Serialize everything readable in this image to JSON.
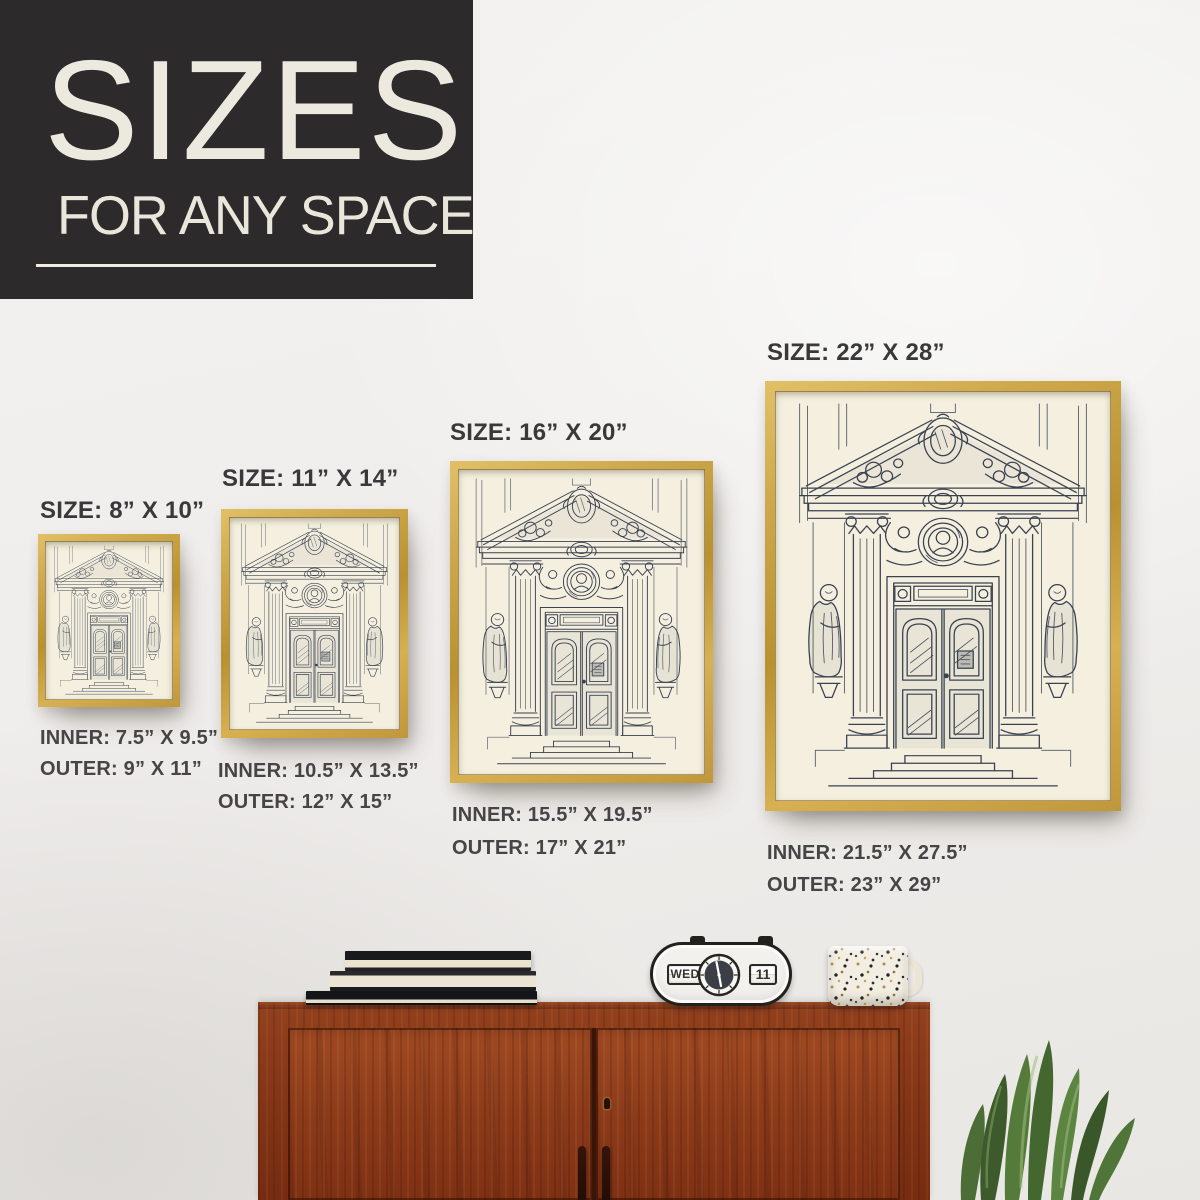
{
  "header": {
    "title": "SIZES",
    "subtitle": "FOR ANY SPACE"
  },
  "frames": [
    {
      "id": "8x10",
      "size_label": "SIZE: 8” X 10”",
      "inner_label": "INNER: 7.5” X 9.5”",
      "outer_label": "OUTER: 9” X 11”"
    },
    {
      "id": "11x14",
      "size_label": "SIZE: 11” X 14”",
      "inner_label": "INNER: 10.5” X 13.5”",
      "outer_label": "OUTER: 12” X 15”"
    },
    {
      "id": "16x20",
      "size_label": "SIZE: 16” X 20”",
      "inner_label": "INNER: 15.5” X 19.5”",
      "outer_label": "OUTER: 17” X 21”"
    },
    {
      "id": "22x28",
      "size_label": "SIZE: 22” X 28”",
      "inner_label": "INNER: 21.5” X 27.5”",
      "outer_label": "OUTER: 23” X 29”"
    }
  ],
  "decor": {
    "clock_day": "WED",
    "clock_date": "11"
  },
  "colors": {
    "header_bg": "#2d2a2b",
    "header_text": "#eceadf",
    "label_text": "#39393b",
    "frame_gold": "#c8a243",
    "art_paper": "#f4efdf",
    "art_ink": "#3a4250",
    "cabinet_wood": "#8a3a1c",
    "wall": "#efedeb"
  }
}
